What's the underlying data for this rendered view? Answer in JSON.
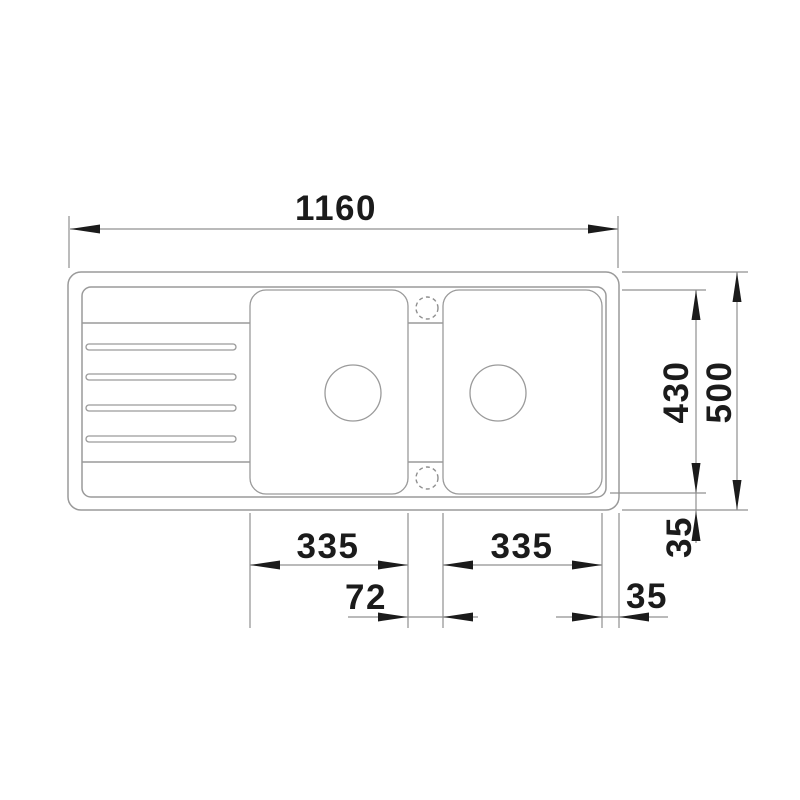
{
  "drawing": {
    "kind": "technical-drawing-top-view",
    "subject": "inset double-bowl sink with drainer",
    "line_color": "#9a9a9a",
    "ink_color": "#1b1b1b",
    "background": "#ffffff",
    "labels": {
      "overall_width": "1160",
      "inner_depth": "430",
      "overall_depth": "500",
      "left_bowl_width": "335",
      "right_bowl_width": "335",
      "bowl_gap": "72",
      "rim_offset_bottom": "35",
      "rim_offset_right": "35"
    }
  }
}
